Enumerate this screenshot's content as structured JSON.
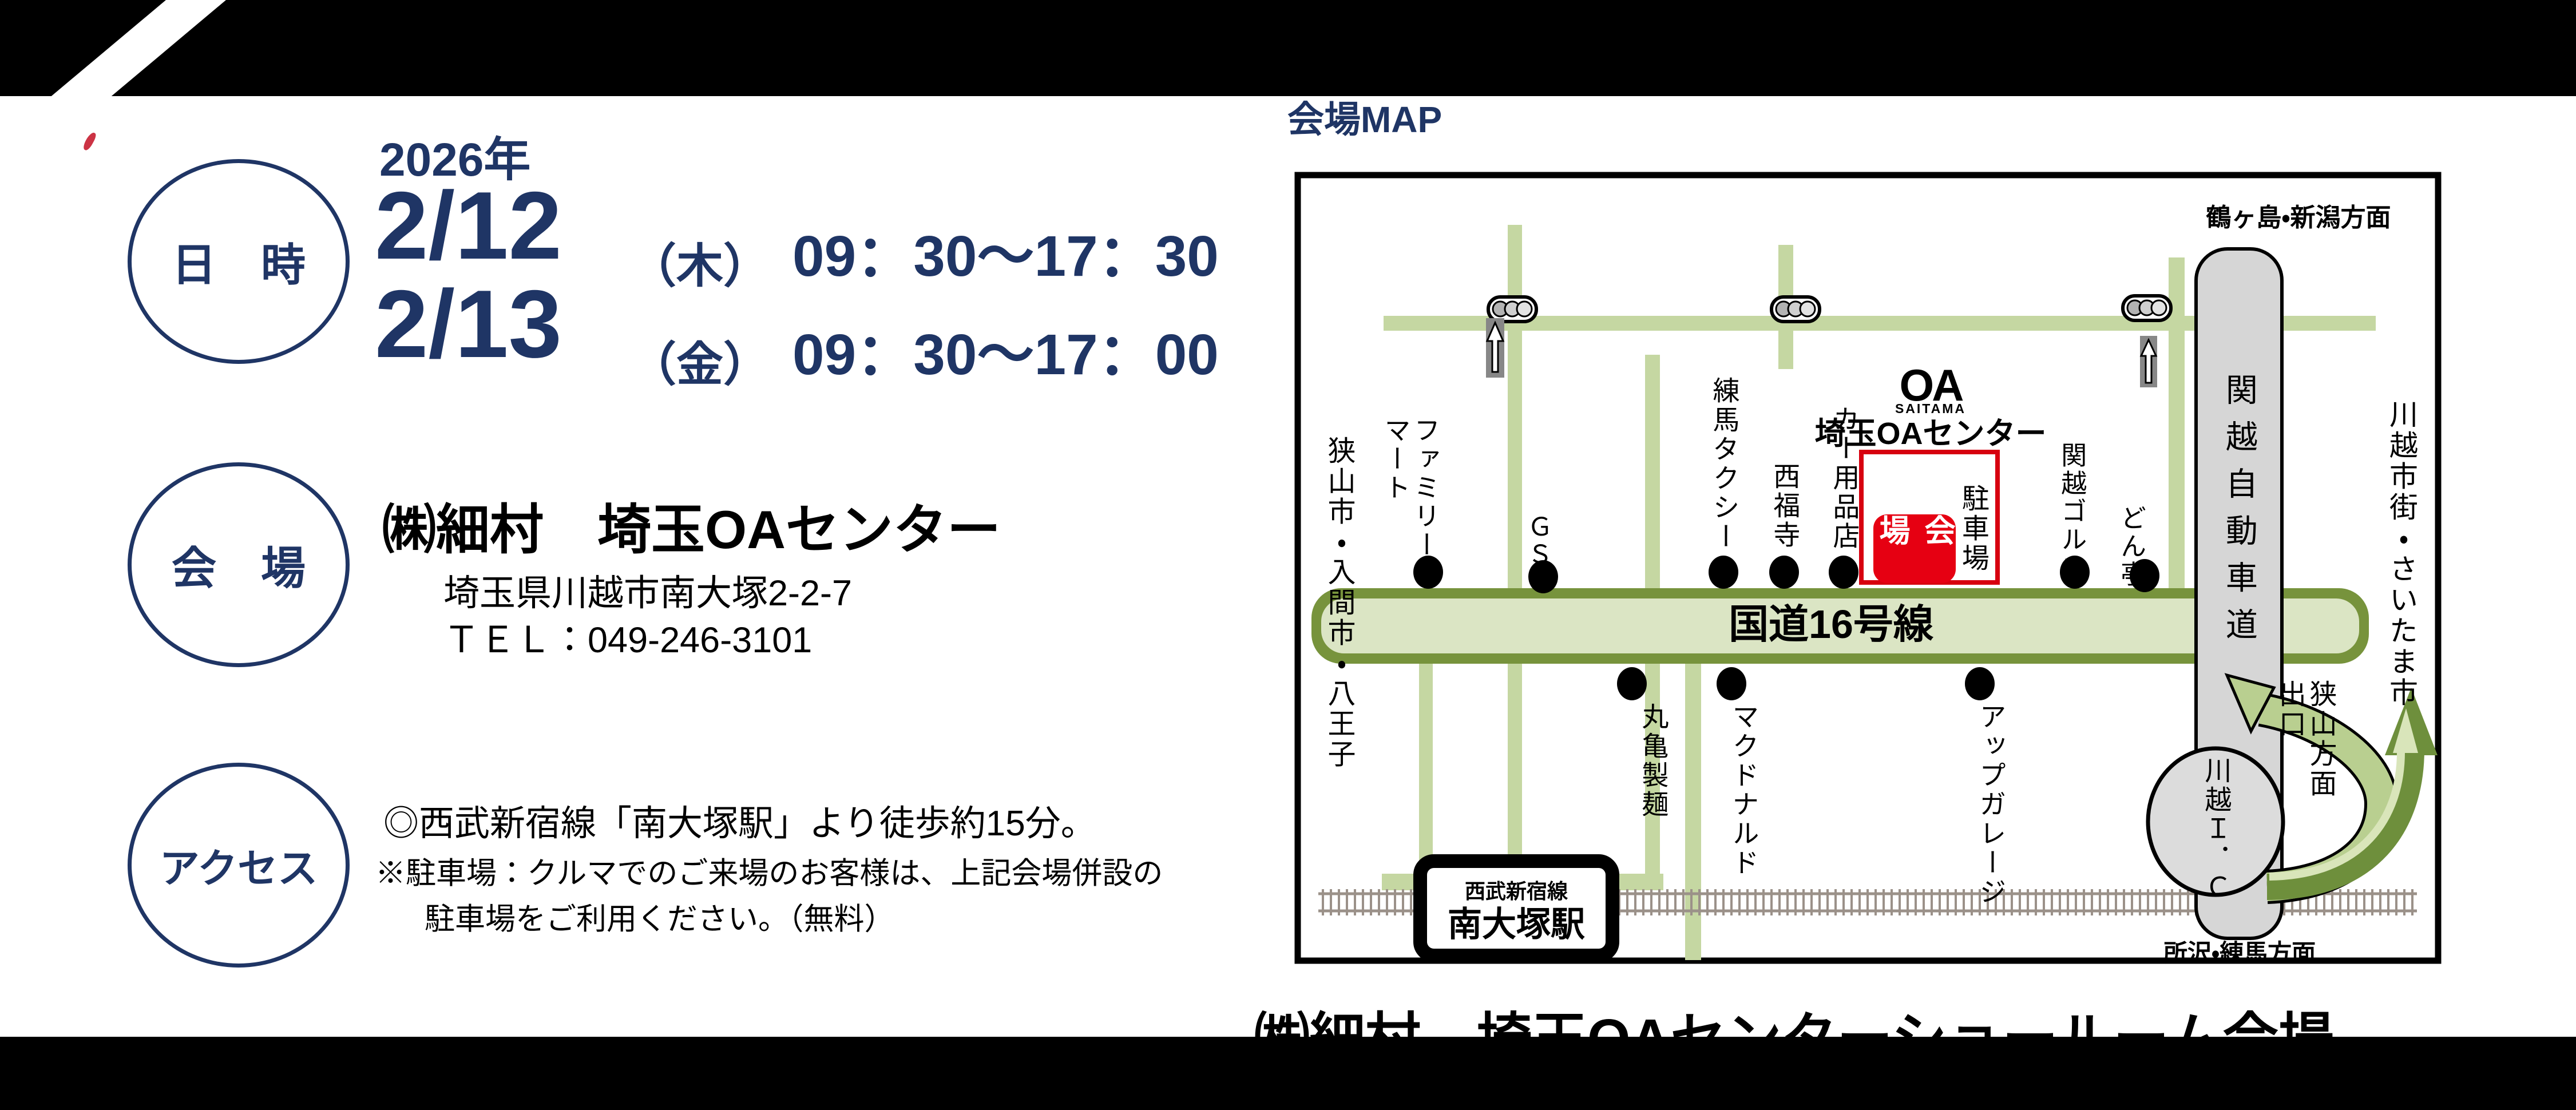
{
  "colors": {
    "navy": "#1f3565",
    "road_green": "#c5d7a2",
    "route16_fill": "#dbe5c4",
    "route16_border": "#77933c",
    "red_accent": "#e60012",
    "red_border": "#d7000f",
    "expressway_gray": "#d6d6d6",
    "ramp_green": "#b9cf90",
    "ramp_dark_green": "#6e8f3c"
  },
  "schedule": {
    "badge": "日　時",
    "year": "2026年",
    "sessions": [
      {
        "date": "2/12",
        "weekday": "（木）",
        "time": "09：30～17：30"
      },
      {
        "date": "2/13",
        "weekday": "（金）",
        "time": "09：30～17：00"
      }
    ]
  },
  "venue": {
    "badge": "会　場",
    "name": "㈱細村　埼玉OAセンター",
    "address": "埼玉県川越市南大塚2-2-7",
    "tel": "ＴＥＬ：049-246-3101"
  },
  "access": {
    "badge": "アクセス",
    "walk": "◎西武新宿線「南大塚駅」より徒歩約15分。",
    "parking_note1": "※駐車場：クルマでのご来場のお客様は、上記会場併設の",
    "parking_note2": "駐車場をご利用ください。（無料）"
  },
  "map": {
    "title": "会場MAP",
    "logo": {
      "mark": "OA",
      "sub": "SAITAMA",
      "name": "埼玉OAセンター"
    },
    "venue_block": {
      "hall": "会場",
      "parking": "駐車場"
    },
    "roads": {
      "route16": "国道16号線",
      "expressway": "関越自動車道",
      "interchange": "川越Ｉ．Ｃ"
    },
    "directions": {
      "north": "鶴ヶ島・新潟方面",
      "south": "所沢・練馬方面",
      "east": "川越市街・さいたま市",
      "west": "狭山市・入間市・八王子",
      "exit": "狭山方面出口"
    },
    "station": {
      "line": "西武新宿線",
      "name": "南大塚駅"
    },
    "landmarks": {
      "famima": "ファミリーマート",
      "gs": "ＧＳ",
      "nerima_taxi": "練馬タクシー",
      "saifukuji": "西福寺",
      "car_shop": "カー用品店",
      "kanetsu_golf": "関越ゴルフ",
      "dontei": "どん亭",
      "marugame": "丸亀製麺",
      "mcdonalds": "マクドナルド",
      "upgarage": "アップガレージ"
    }
  },
  "footer": {
    "text": "㈱細村　埼玉OAセンターショールーム会場"
  }
}
